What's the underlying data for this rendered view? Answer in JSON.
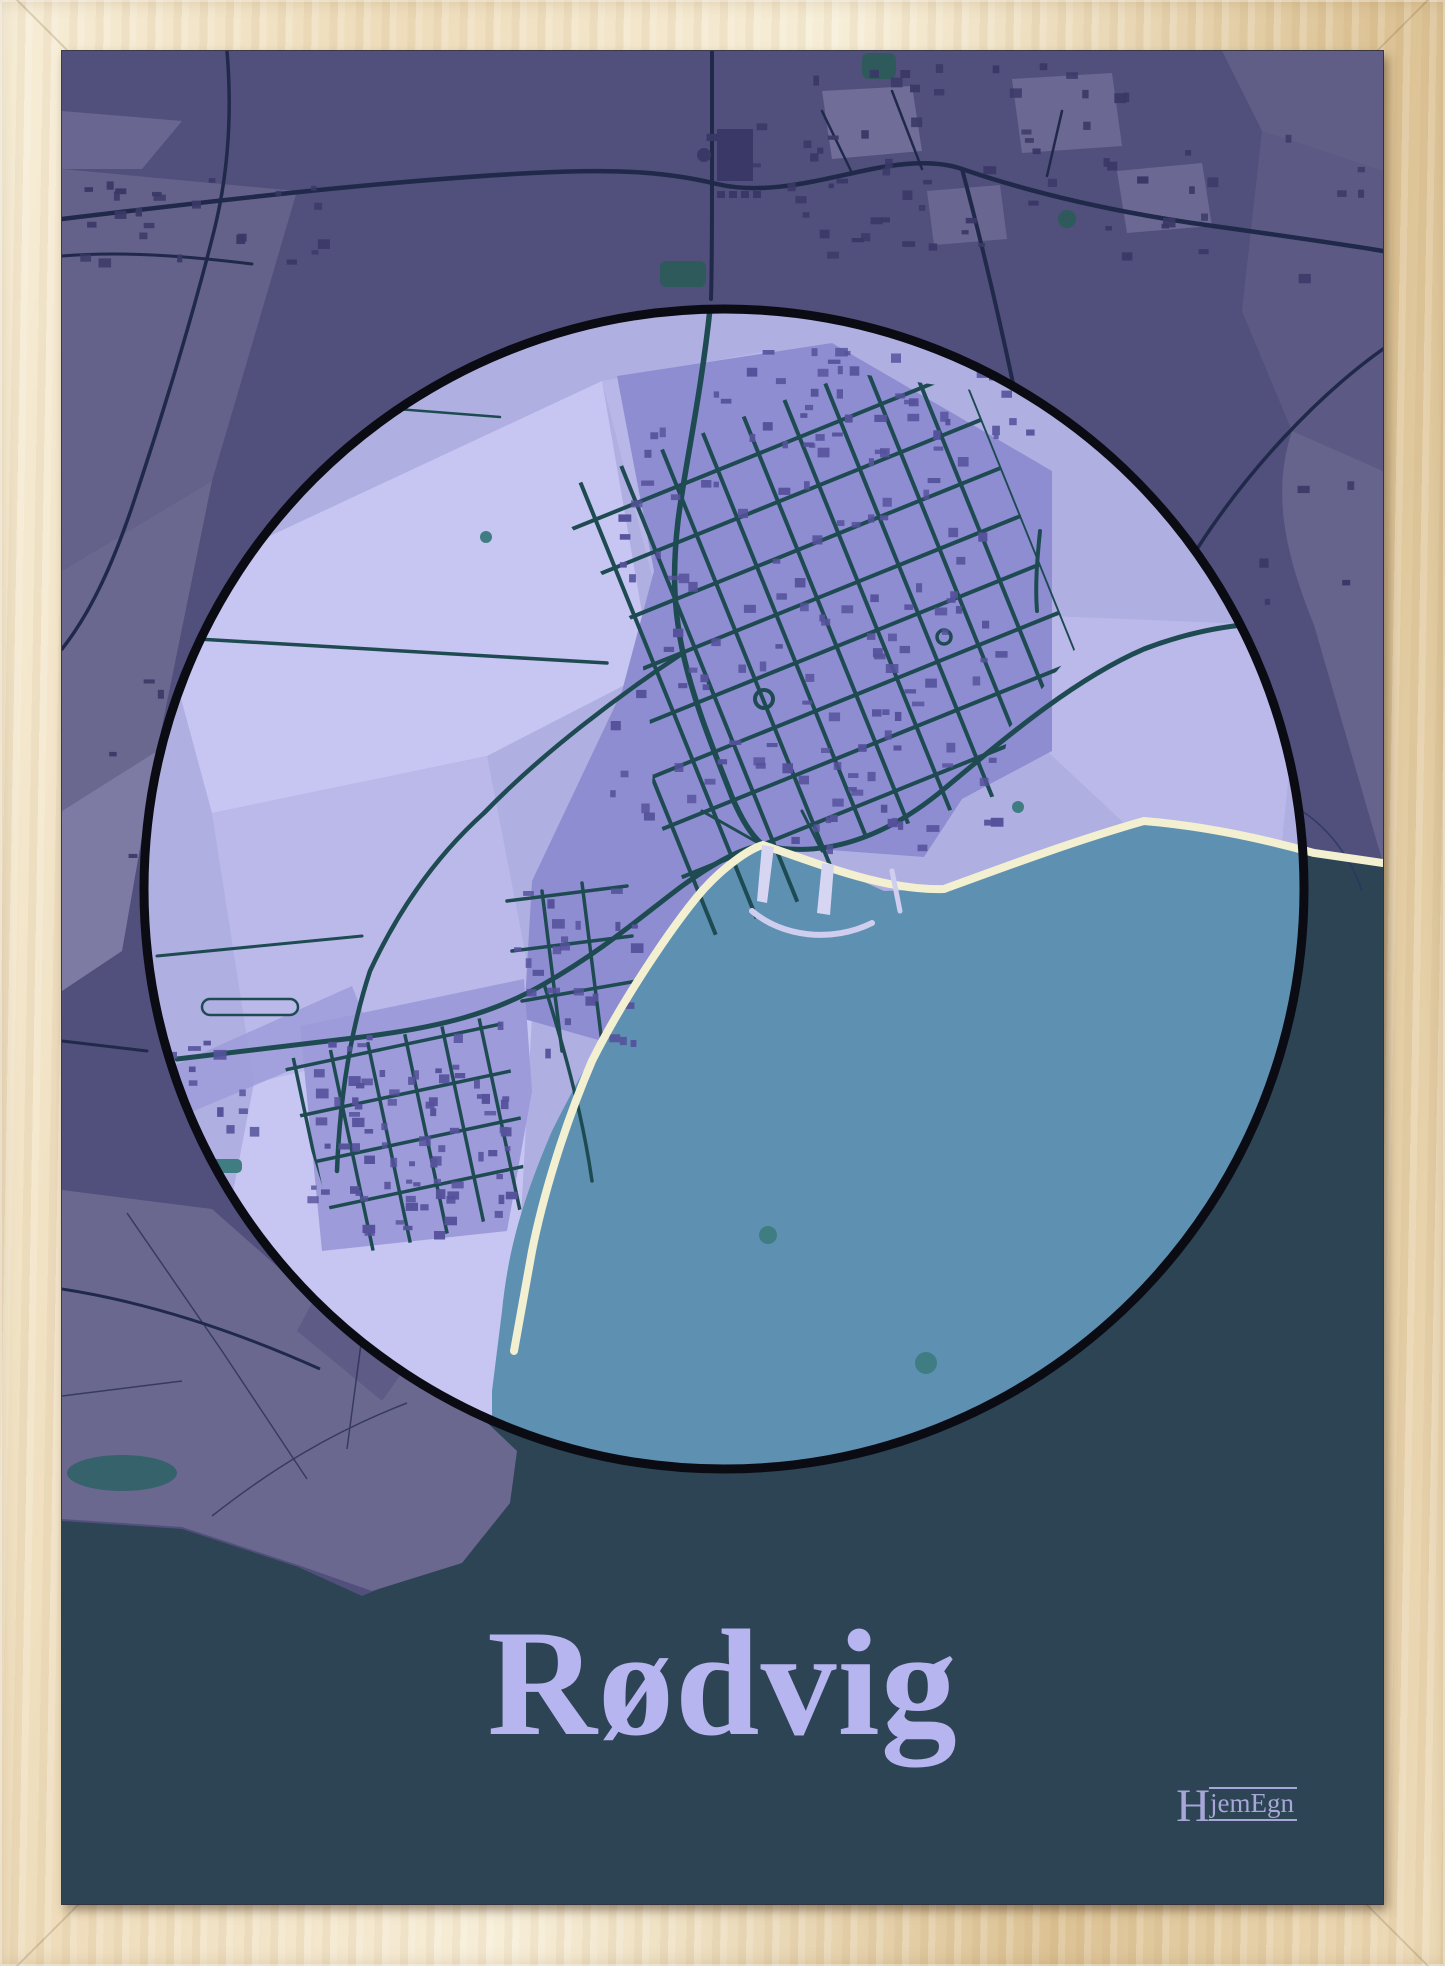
{
  "poster": {
    "title": "Rødvig",
    "logo": {
      "initial": "H",
      "rest": "jemEgn"
    }
  },
  "palette": {
    "frame_wood": "#eedcba",
    "frame_wood_light": "#f7eed8",
    "frame_wood_dark": "#dcc294",
    "map_outer": "#514f7c",
    "map_outer_light": "#6b6890",
    "map_outer_lighter": "#7d7aa4",
    "outer_building": "#3a3866",
    "outer_road": "#20294a",
    "outer_green": "#2e5a5c",
    "deep_water": "#2c4454",
    "circle_land": "#b0afe2",
    "field_light": "#c7c6f2",
    "field_mid": "#bab9ea",
    "town_fill": "#8f8dd1",
    "residential_fill": "#9d9bda",
    "inner_building": "#55529b",
    "inner_road": "#1e4b52",
    "inner_green": "#3f7d82",
    "circle_water": "#5e90b2",
    "beach": "#f2f0d0",
    "ring": "#0b0b14",
    "title_color": "#b7b5f0",
    "logo_color": "#a8a6d8"
  }
}
